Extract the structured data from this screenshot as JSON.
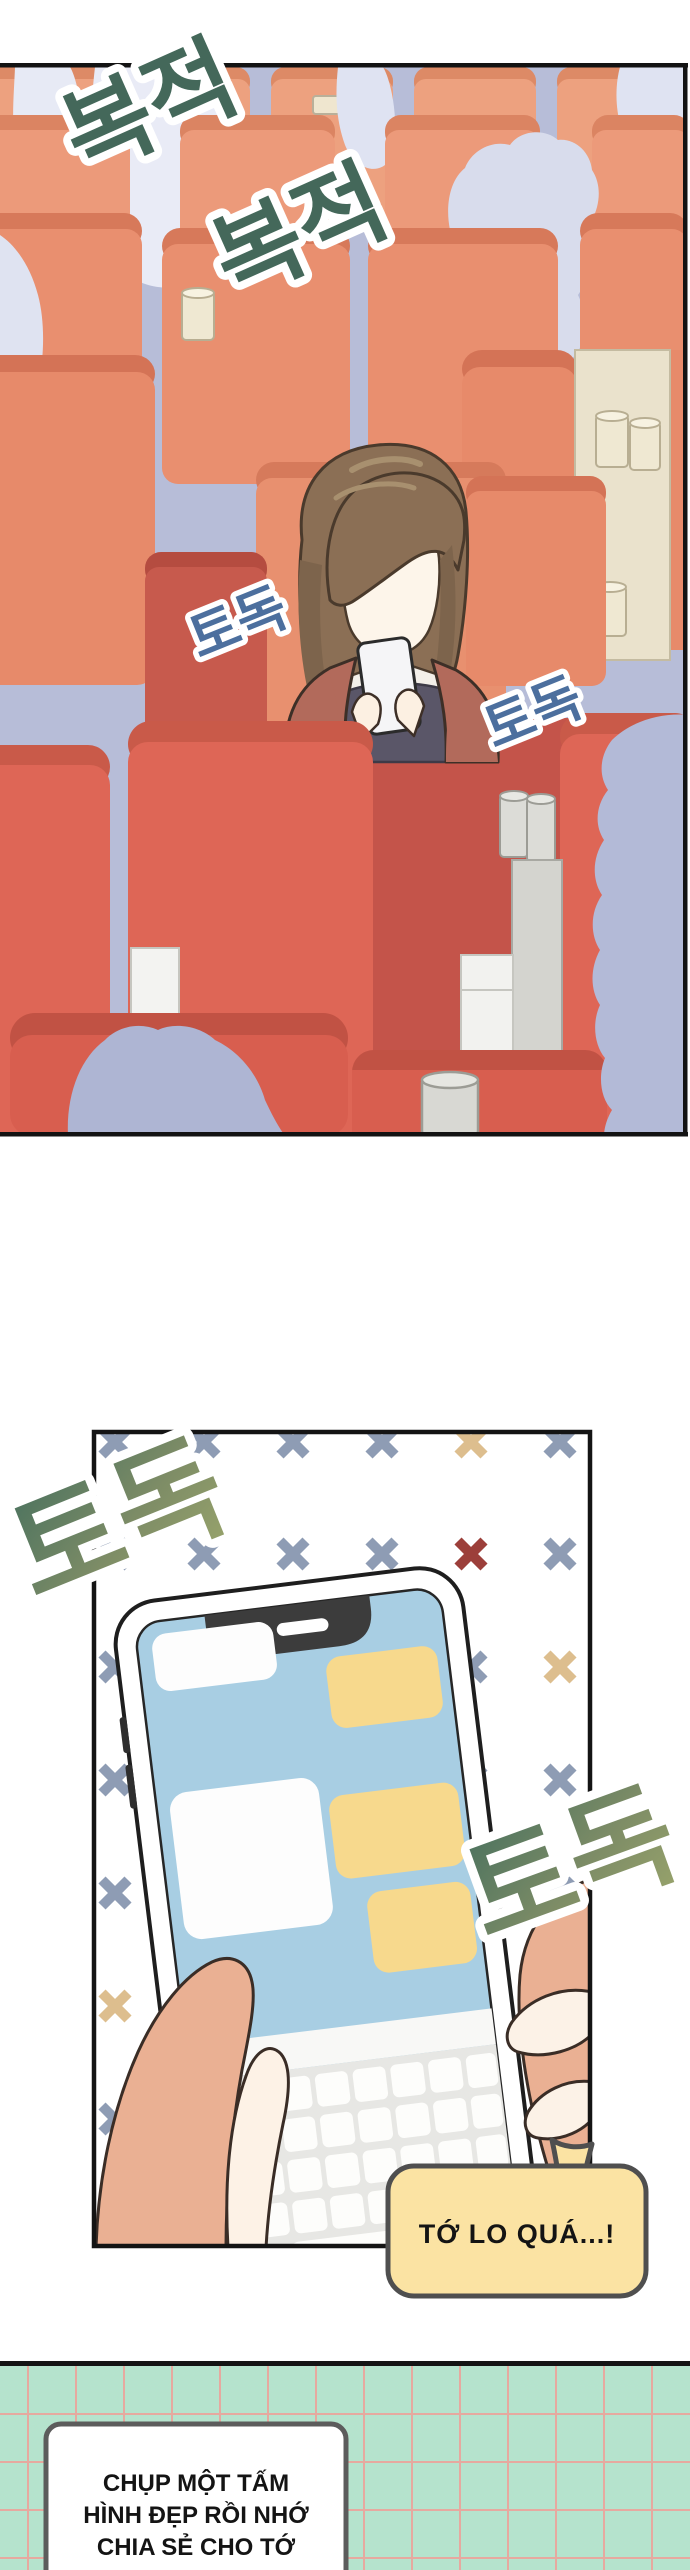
{
  "sfx": {
    "rustle_1": "복적",
    "rustle_2": "복적",
    "tap_small_1": "토독",
    "tap_small_2": "토독",
    "tap_big_1": "토독",
    "tap_big_2": "토독"
  },
  "dialogue": {
    "speech_bubble": "TỚ LO QUÁ...!",
    "caption_lines": [
      "CHỤP MỘT TẤM",
      "HÌNH ĐẸP RỒI NHỚ",
      "CHIA SẺ CHO TỚ"
    ]
  },
  "colors": {
    "panel_wall": "#b7bdd8",
    "seat_back_rows": "#eda17f",
    "seat_front_rows": "#de6656",
    "crowd_silhouette_light": "#e9ebf6",
    "crowd_silhouette_front": "#aeb5d3",
    "sfx_green": "#44685a",
    "sfx_blue": "#4c6f9e",
    "sfx_green_gradient_start": "#47705e",
    "sfx_green_gradient_end": "#9ba66c",
    "phone_screen_blue": "#a8cee3",
    "chat_bubble_yellow": "#f7d98d",
    "chat_bubble_white": "#fdfdfd",
    "speech_bubble_yellow": "#fbe3a3",
    "grid_mint": "#b5e3cd",
    "grid_line_pink": "#ef9f98",
    "x_slate": "#8e9cb4",
    "x_tan": "#ddbe8e",
    "x_red": "#9c3f3a",
    "skin_arm": "#eab093",
    "skin_hand_light": "#fdf2e6",
    "jacket_maroon": "#b26a5b",
    "hair_brown": "#8b6f55"
  }
}
